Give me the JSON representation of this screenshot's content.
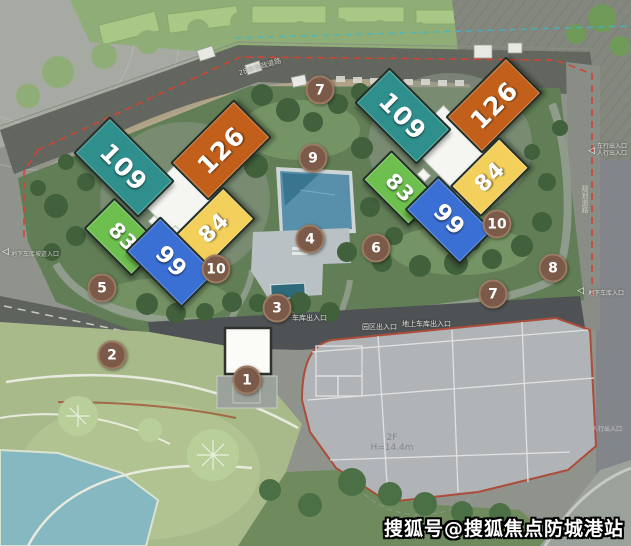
{
  "buildings": [
    {
      "id": "west-109",
      "label": "109",
      "color": "#2E8F8C"
    },
    {
      "id": "west-126",
      "label": "126",
      "color": "#C2601B"
    },
    {
      "id": "west-83",
      "label": "83",
      "color": "#6DBF4E"
    },
    {
      "id": "west-84",
      "label": "84",
      "color": "#F3CF5B"
    },
    {
      "id": "west-99",
      "label": "99",
      "color": "#3A6FD3"
    },
    {
      "id": "east-109",
      "label": "109",
      "color": "#2E8F8C"
    },
    {
      "id": "east-126",
      "label": "126",
      "color": "#C2601B"
    },
    {
      "id": "east-83",
      "label": "83",
      "color": "#6DBF4E"
    },
    {
      "id": "east-84",
      "label": "84",
      "color": "#F3CF5B"
    },
    {
      "id": "east-99",
      "label": "99",
      "color": "#3A6FD3"
    }
  ],
  "markers": [
    {
      "n": "1"
    },
    {
      "n": "2"
    },
    {
      "n": "3"
    },
    {
      "n": "4"
    },
    {
      "n": "5"
    },
    {
      "n": "6"
    },
    {
      "n": "7"
    },
    {
      "n": "7"
    },
    {
      "n": "8"
    },
    {
      "n": "9"
    },
    {
      "n": "10"
    },
    {
      "n": "10"
    }
  ],
  "labels": {
    "road_top": "28米市政道路",
    "road_right": "规划道路",
    "gate_west": "地下车库坡道入口",
    "gate_south_1": "车库出入口",
    "gate_south_2": "园区出入口",
    "gate_south_3": "地上车库出入口",
    "gate_east_line1": "车行出入口",
    "gate_east_line2": "人行出入口",
    "gate_east_lower": "地下车库入口",
    "gate_southeast": "人行出入口",
    "plot_floors": "2F",
    "plot_height": "H=14.4m",
    "arrow": "◁"
  },
  "watermark": {
    "text": "搜狐号@搜狐焦点防城港站",
    "fill": "#FFFFFF",
    "outline": "#000000"
  },
  "palette": {
    "marker_brown": "#7B5A49",
    "boundary_red": "#D14434",
    "pool_blue": "#5890AC",
    "lake_blue": "#85B8C1",
    "site_green": "#617E56",
    "road_grey": "#62665E",
    "plot_grey": "#B1B4B7"
  }
}
